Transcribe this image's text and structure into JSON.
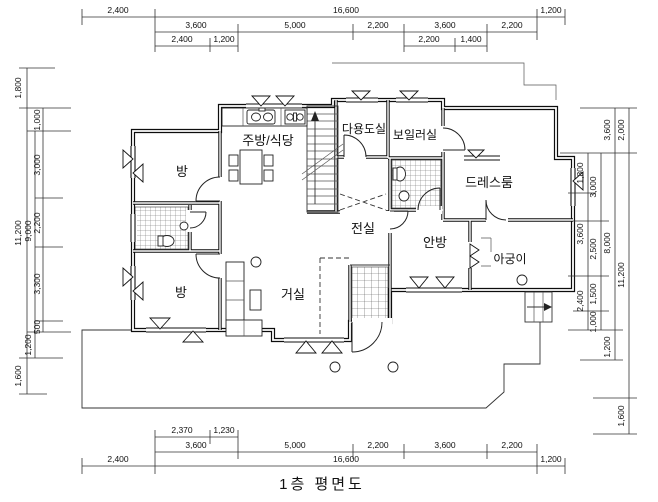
{
  "title": "1층 평면도",
  "rooms": {
    "kitchen": "주방/식당",
    "utility": "다용도실",
    "boiler": "보일러실",
    "dressroom": "드레스룸",
    "room_top": "방",
    "room_bottom": "방",
    "vestibule": "전실",
    "master": "안방",
    "agungi": "아궁이",
    "living": "거실"
  },
  "dims": {
    "top": {
      "row1": [
        "2,400",
        "16,600",
        "1,200"
      ],
      "row2": [
        "3,600",
        "5,000",
        "2,200",
        "3,600",
        "2,200"
      ],
      "row3_left": [
        "2,400",
        "1,200"
      ],
      "row3_right": [
        "2,200",
        "1,400"
      ]
    },
    "bottom": {
      "row1": [
        "2,370",
        "1,230"
      ],
      "row2": [
        "3,600",
        "5,000",
        "2,200",
        "3,600",
        "2,200"
      ],
      "row3": [
        "2,400",
        "16,600",
        "1,200"
      ]
    },
    "left": {
      "outer": [
        "1,800",
        "11,200",
        "1,600"
      ],
      "mid": [
        "9,000",
        "1,200"
      ],
      "inner": [
        "1,000",
        "3,000",
        "2,200",
        "3,300",
        "500"
      ]
    },
    "right": {
      "inner1": [
        "1,800",
        "3,600",
        "2,400"
      ],
      "inner2": [
        "3,000",
        "2,500",
        "1,500",
        "1,000"
      ],
      "col3": [
        "3,600",
        "8,000",
        "1,200"
      ],
      "outer": [
        "2,000",
        "11,200",
        "1,600"
      ]
    }
  }
}
